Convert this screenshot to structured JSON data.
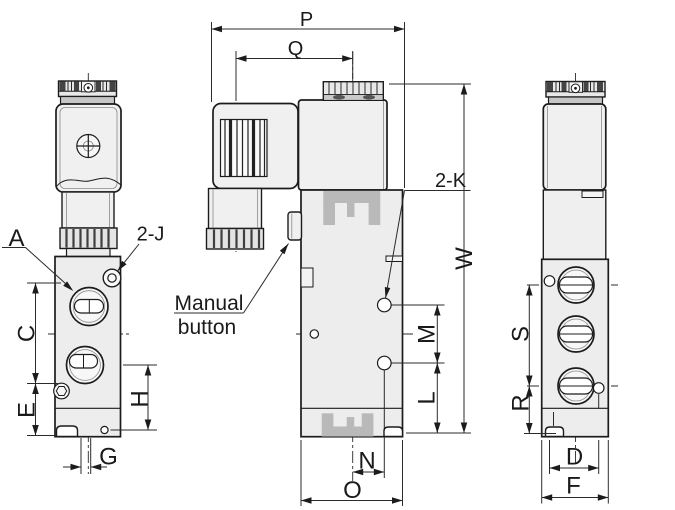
{
  "diagram": {
    "type": "technical-drawing",
    "subject": "Pneumatic solenoid valve dimensional drawing with three orthographic views",
    "annotations": {
      "manual_button_line1": "Manual",
      "manual_button_line2": "button"
    },
    "dimension_labels": {
      "p": "P",
      "q": "Q",
      "w": "W",
      "m": "M",
      "l": "L",
      "n": "N",
      "o": "O",
      "a": "A",
      "two_j": "2-J",
      "two_k": "2-K",
      "c": "C",
      "e": "E",
      "h": "H",
      "g": "G",
      "s": "S",
      "r": "R",
      "d": "D",
      "f": "F"
    },
    "colors": {
      "line": "#1c1c1c",
      "body_fill": "#ededed",
      "cap_band": "#c6c6c6",
      "logo_gray": "#b9b9b9",
      "background": "#ffffff"
    }
  }
}
